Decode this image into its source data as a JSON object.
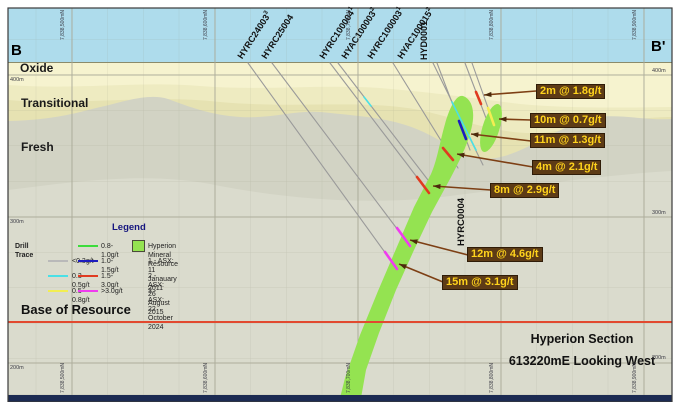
{
  "section": {
    "label_left": "B",
    "label_right": "B'",
    "title": "Hyperion Section",
    "subtitle": "613220mE Looking West"
  },
  "layers": {
    "oxide": "Oxide",
    "transitional": "Transitional",
    "fresh": "Fresh",
    "base_of_resource": "Base of Resource"
  },
  "drill_labels": [
    {
      "name": "HYRC24003",
      "sup": "3"
    },
    {
      "name": "HYRC25004",
      "sup": ""
    },
    {
      "name": "HYRC100004",
      "sup": "1"
    },
    {
      "name": "HYAC100003",
      "sup": "2"
    },
    {
      "name": "HYRC100003",
      "sup": "1"
    },
    {
      "name": "HYAC100015",
      "sup": "2"
    },
    {
      "name": "HYD0001",
      "sup": ""
    }
  ],
  "drill_trace_label": "HYRC0004",
  "callouts": [
    {
      "label": "2m @ 1.8g/t"
    },
    {
      "label": "10m @ 0.7g/t"
    },
    {
      "label": "11m @ 1.3g/t"
    },
    {
      "label": "4m @ 2.1g/t"
    },
    {
      "label": "8m @ 2.9g/t"
    },
    {
      "label": "12m @ 4.6g/t"
    },
    {
      "label": "15m @ 3.1g/t"
    }
  ],
  "legend": {
    "title": "Legend",
    "drill_trace_header": "Drill Trace",
    "col1": [
      {
        "label": "<0.3g/t",
        "color": "#b9b9b9"
      },
      {
        "label": "0.3-0.5g/t",
        "color": "#4ae0e6"
      },
      {
        "label": "0.5-0.8g/t",
        "color": "#f2ee52"
      }
    ],
    "col2": [
      {
        "label": "0.8-1.0g/t",
        "color": "#3cdc3c"
      },
      {
        "label": "1.0-1.5g/t",
        "color": "#1d1dbe"
      },
      {
        "label": "1.5-3.0g/t",
        "color": "#e03b20"
      },
      {
        "label": ">3.0g/t",
        "color": "#ef3cef"
      }
    ],
    "resource_label": "Hyperion Mineral Resource",
    "footnotes": [
      "1 - ASX: 11 Janauary 2011",
      "2 - ASX: 26 August 2015",
      "3 - ASX: 22 October 2024"
    ]
  },
  "axes": {
    "northings": [
      "7,838,500mN",
      "7,838,600mN",
      "7,838,700mN",
      "7,838,800mN",
      "7,838,900mN"
    ],
    "elevations": [
      "400m",
      "300m",
      "200m"
    ]
  },
  "colors": {
    "sky": "#aedcec",
    "oxide": "#f6f3cf",
    "transitional": "#eeebc1",
    "transitional_deep": "#e6e2b2",
    "fresh_hill": "#d2d3c4",
    "fresh": "#dadbcd",
    "grid": "#a9a997",
    "surface": "#8b8b6b",
    "trace": "#9a9a9a",
    "resource": "#94e351",
    "resource_edge": "#63b32e",
    "base_line": "#e2492f",
    "callout_bg": "#5d3b16",
    "callout_text": "#ffd31c",
    "callout_border": "#2f1c08",
    "arrow": "#7d3f14",
    "navy_strip": "#1c2b52",
    "legend_title": "#16167f",
    "grade_lt03": "#b9b9b9",
    "grade_03_05": "#4ae0e6",
    "grade_05_08": "#f2ee52",
    "grade_08_10": "#3cdc3c",
    "grade_10_15": "#1d1dbe",
    "grade_15_30": "#e03b20",
    "grade_gt30": "#ef3cef"
  }
}
